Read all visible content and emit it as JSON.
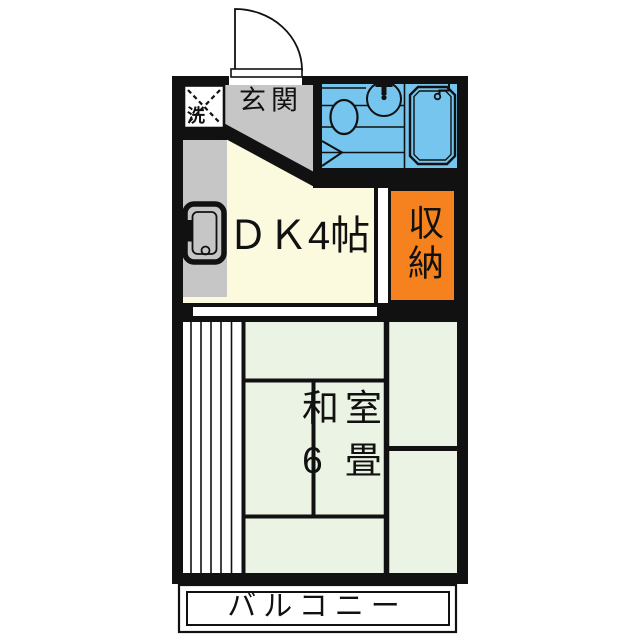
{
  "labels": {
    "entrance": "玄関",
    "washer_space": "洗",
    "dining_kitchen": "ＤＫ4帖",
    "storage": "収納",
    "japanese_room_name": "和室",
    "japanese_room_size": "6 畳",
    "balcony": "バルコニー"
  },
  "colors": {
    "background": "#ffffff",
    "wall": "#111111",
    "text": "#111111",
    "dk_floor": "#fcfade",
    "entrance_floor": "#c6c6c6",
    "tatami_floor": "#eaf3e4",
    "bathroom_floor": "#75c5ee",
    "storage_fill": "#f5821e",
    "fixture_white": "#ffffff"
  }
}
